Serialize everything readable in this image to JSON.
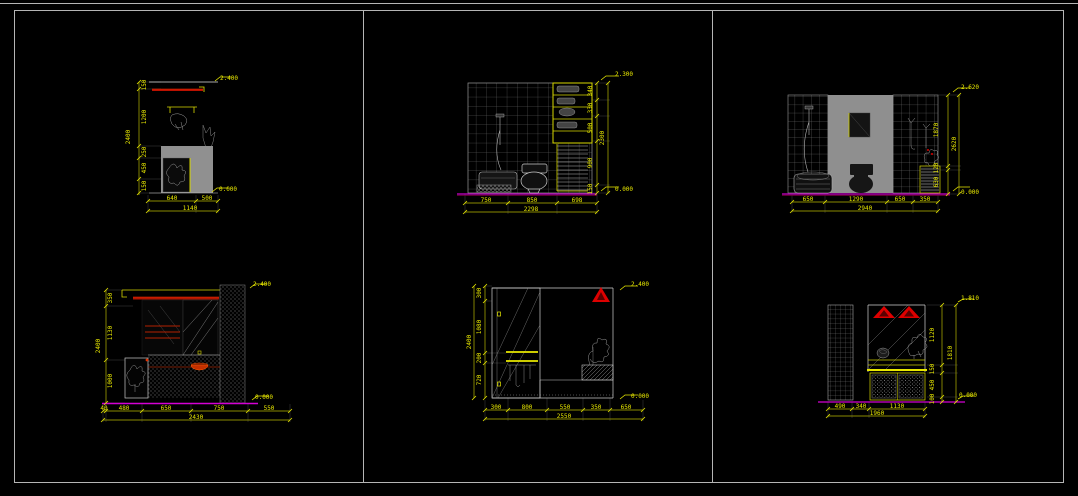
{
  "colors": {
    "background": "#000000",
    "dimension_yellow": "#e8e800",
    "red_accent": "#dd0000",
    "magenta_floor": "#d400d4",
    "wall_gray": "#8f8f8f",
    "line_white": "#d9d9d9",
    "border_gray": "#b5b5b5"
  },
  "panels": [
    {
      "left_chain": [
        "150",
        "1200",
        "250",
        "450",
        "150"
      ],
      "left_total": "2400",
      "bottom": [
        "640",
        "500"
      ],
      "bottom_total": "1140",
      "marker_top": "2.400",
      "marker_bottom": "0.000"
    },
    {
      "right_chain": [
        "340",
        "330",
        "500",
        "900",
        "150"
      ],
      "right_total": "2300",
      "bottom": [
        "750",
        "850",
        "698"
      ],
      "bottom_total": "2298",
      "marker_top": "2.300",
      "marker_bottom": "0.000"
    },
    {
      "right_chain": [
        "1870",
        "120",
        "630"
      ],
      "right_total": "2620",
      "bottom": [
        "650",
        "1290",
        "650",
        "350"
      ],
      "bottom_total": "2940",
      "marker_top": "2.620",
      "marker_bottom": "0.000"
    },
    {
      "left_chain": [
        "350",
        "1130",
        "1000"
      ],
      "left_total": "2400",
      "bottom": [
        "40",
        "480",
        "650",
        "750",
        "550"
      ],
      "bottom_total": "2430",
      "marker_top": "2.400",
      "marker_bottom": "0.000"
    },
    {
      "left_chain": [
        "300",
        "1080",
        "200",
        "720"
      ],
      "left_total": "2400",
      "bottom": [
        "300",
        "800",
        "550",
        "350",
        "650"
      ],
      "bottom_total": "2550",
      "marker_top": "2.400",
      "marker_bottom": "0.000"
    },
    {
      "right_chain": [
        "1120",
        "150",
        "450",
        "100"
      ],
      "right_total": "1810",
      "bottom": [
        "490",
        "340",
        "1130"
      ],
      "bottom_total": "1960",
      "marker_top": "1.810",
      "marker_bottom": "0.000"
    }
  ]
}
